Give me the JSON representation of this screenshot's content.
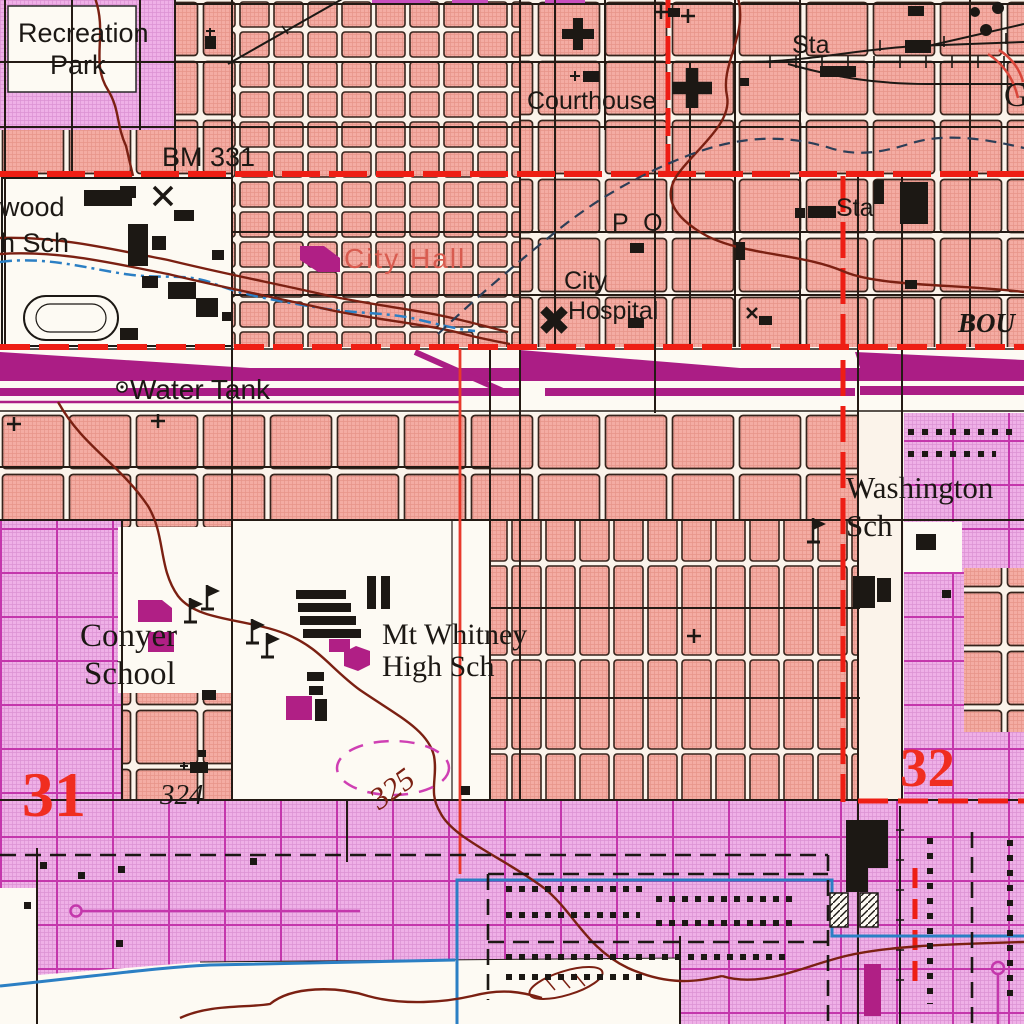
{
  "map": {
    "kind": "USGS topographic city map",
    "colors": {
      "paper": "#fbf3ea",
      "urban_pink": "#f4aca3",
      "urban_purple": "#efb0e7",
      "rail_magenta": "#ab1d85",
      "highway_red": "#ee1e14",
      "contour_brown": "#7b2012",
      "water_blue": "#2b7fc4",
      "ink_black": "#1c1814",
      "landmark_label_red": "#d85c50",
      "section_number_red": "#f02d20"
    },
    "labels": [
      {
        "id": "recreation-park-line1",
        "text": "Recreation"
      },
      {
        "id": "recreation-park-line2",
        "text": "Park"
      },
      {
        "id": "courthouse",
        "text": "Courthouse"
      },
      {
        "id": "station-top",
        "text": "Sta"
      },
      {
        "id": "partial-name-right-top",
        "text": "G"
      },
      {
        "id": "benchmark",
        "text": "BM 331"
      },
      {
        "id": "school-left-line1",
        "text": "wood"
      },
      {
        "id": "school-left-line2",
        "text": "h Sch"
      },
      {
        "id": "city-hall",
        "text": "City Hall"
      },
      {
        "id": "post-office",
        "text": "P O"
      },
      {
        "id": "city-hospital-line1",
        "text": "City"
      },
      {
        "id": "city-hospital-line2",
        "text": "Hospital"
      },
      {
        "id": "station-right",
        "text": "Sta"
      },
      {
        "id": "boulevard-partial",
        "text": "BOU"
      },
      {
        "id": "water-tank",
        "text": "Water Tank"
      },
      {
        "id": "washington-sch-line1",
        "text": "Washington"
      },
      {
        "id": "washington-sch-line2",
        "text": "Sch"
      },
      {
        "id": "conyer-school-line1",
        "text": "Conyer"
      },
      {
        "id": "conyer-school-line2",
        "text": "School"
      },
      {
        "id": "mt-whitney-line1",
        "text": "Mt Whitney"
      },
      {
        "id": "mt-whitney-line2",
        "text": "High Sch"
      },
      {
        "id": "section-31",
        "text": "31"
      },
      {
        "id": "section-32",
        "text": "32"
      },
      {
        "id": "spot-elevation-324",
        "text": "324"
      },
      {
        "id": "contour-325",
        "text": "325"
      }
    ]
  }
}
